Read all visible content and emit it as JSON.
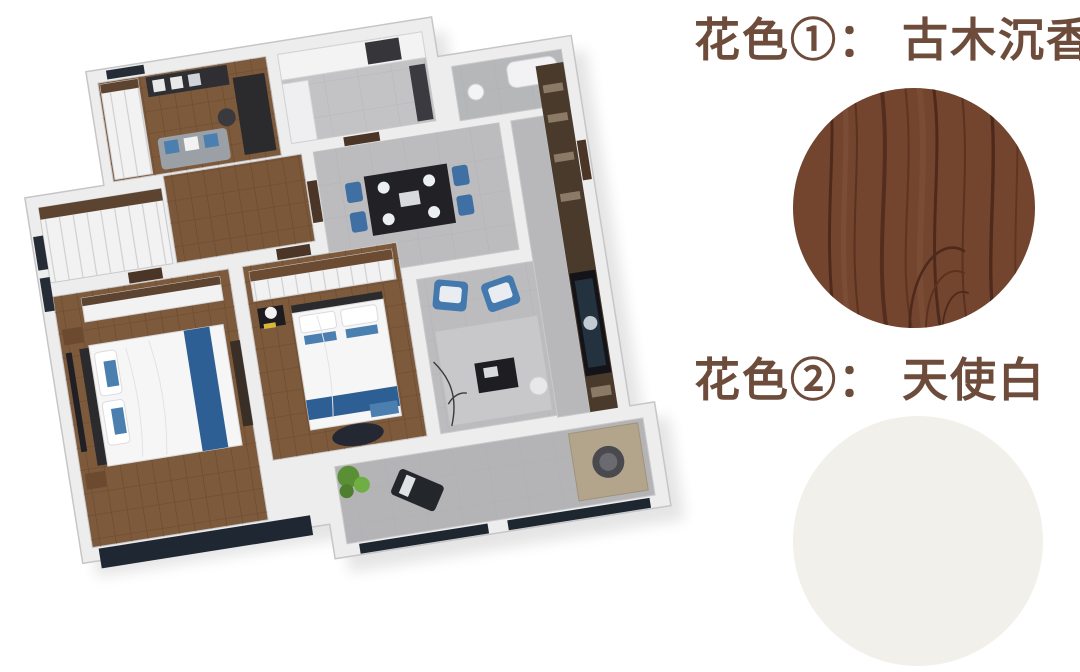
{
  "page": {
    "background": "#ffffff"
  },
  "swatches": [
    {
      "prefix": "花色①：",
      "name": "古木沉香",
      "style": "wood-grain",
      "colors": {
        "base": "#73452f",
        "grain_dark": "#4e2a1c",
        "grain_light": "#8a5a40"
      }
    },
    {
      "prefix": "花色②：",
      "name": "天使白",
      "style": "solid",
      "colors": {
        "base": "#f1f0ea"
      }
    }
  ],
  "label_style": {
    "color": "#6e4c3b"
  },
  "floorplan": {
    "type": "3d-isometric-apartment-render",
    "rooms": [
      "study",
      "kitchen",
      "bathroom",
      "hallway",
      "dining-room",
      "living-room",
      "master-bedroom",
      "second-bedroom",
      "entry-hall",
      "balcony"
    ],
    "palette": {
      "wall": "#ededee",
      "wall_edge": "#c6c6c8",
      "tile_floor": "#bcbcbf",
      "wood_floor": "#7d5a3c",
      "furniture_dark": "#28282c",
      "accent_blue": "#3f6fa3",
      "bedding_blue": "#2e5f94",
      "bedding_white": "#f6f6f7",
      "plant_green": "#6aa23c",
      "cabinet_wood": "#5d4430",
      "entry_cabinet": "#4a3a2c",
      "window_glass": "#1f2733"
    }
  }
}
